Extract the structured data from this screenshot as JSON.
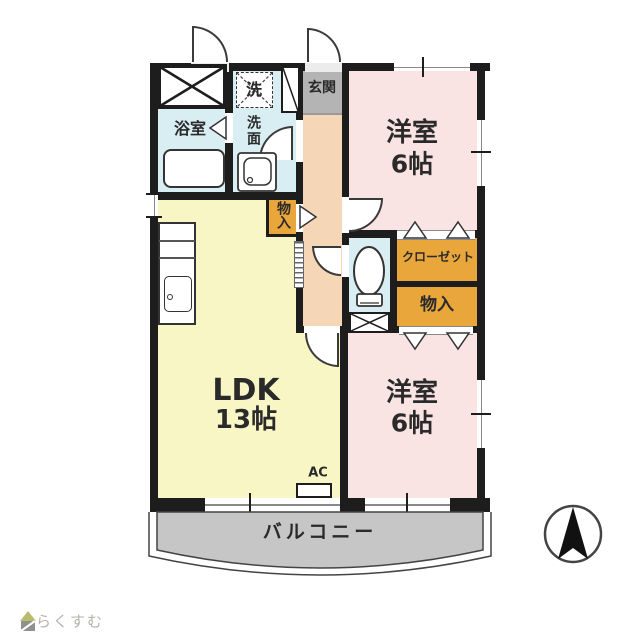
{
  "rooms": {
    "entrance": "玄関",
    "washer": "洗",
    "washroom": "洗面",
    "bathroom": "浴室",
    "bedroom_top_label": "洋室",
    "bedroom_top_size": "6帖",
    "closet": "クローゼット",
    "storage_right": "物入",
    "storage_hall": "物入",
    "ldk_label": "LDK",
    "ldk_size": "13帖",
    "bedroom_bottom_label": "洋室",
    "bedroom_bottom_size": "6帖",
    "ac": "AC",
    "balcony": "バルコニー"
  },
  "watermark": "らくすむ",
  "compass": "N",
  "colors": {
    "wall": "#1d1d1d",
    "bedroom_pink": "#fae4e3",
    "ldk_yellow": "#f9f6c5",
    "wet_area_blue": "#d9eef3",
    "storage_orange": "#e8a63b",
    "entrance_gray": "#b4b4b4",
    "balcony_gray": "#c6c6c6",
    "hallway_beige": "#f5d6b6"
  }
}
